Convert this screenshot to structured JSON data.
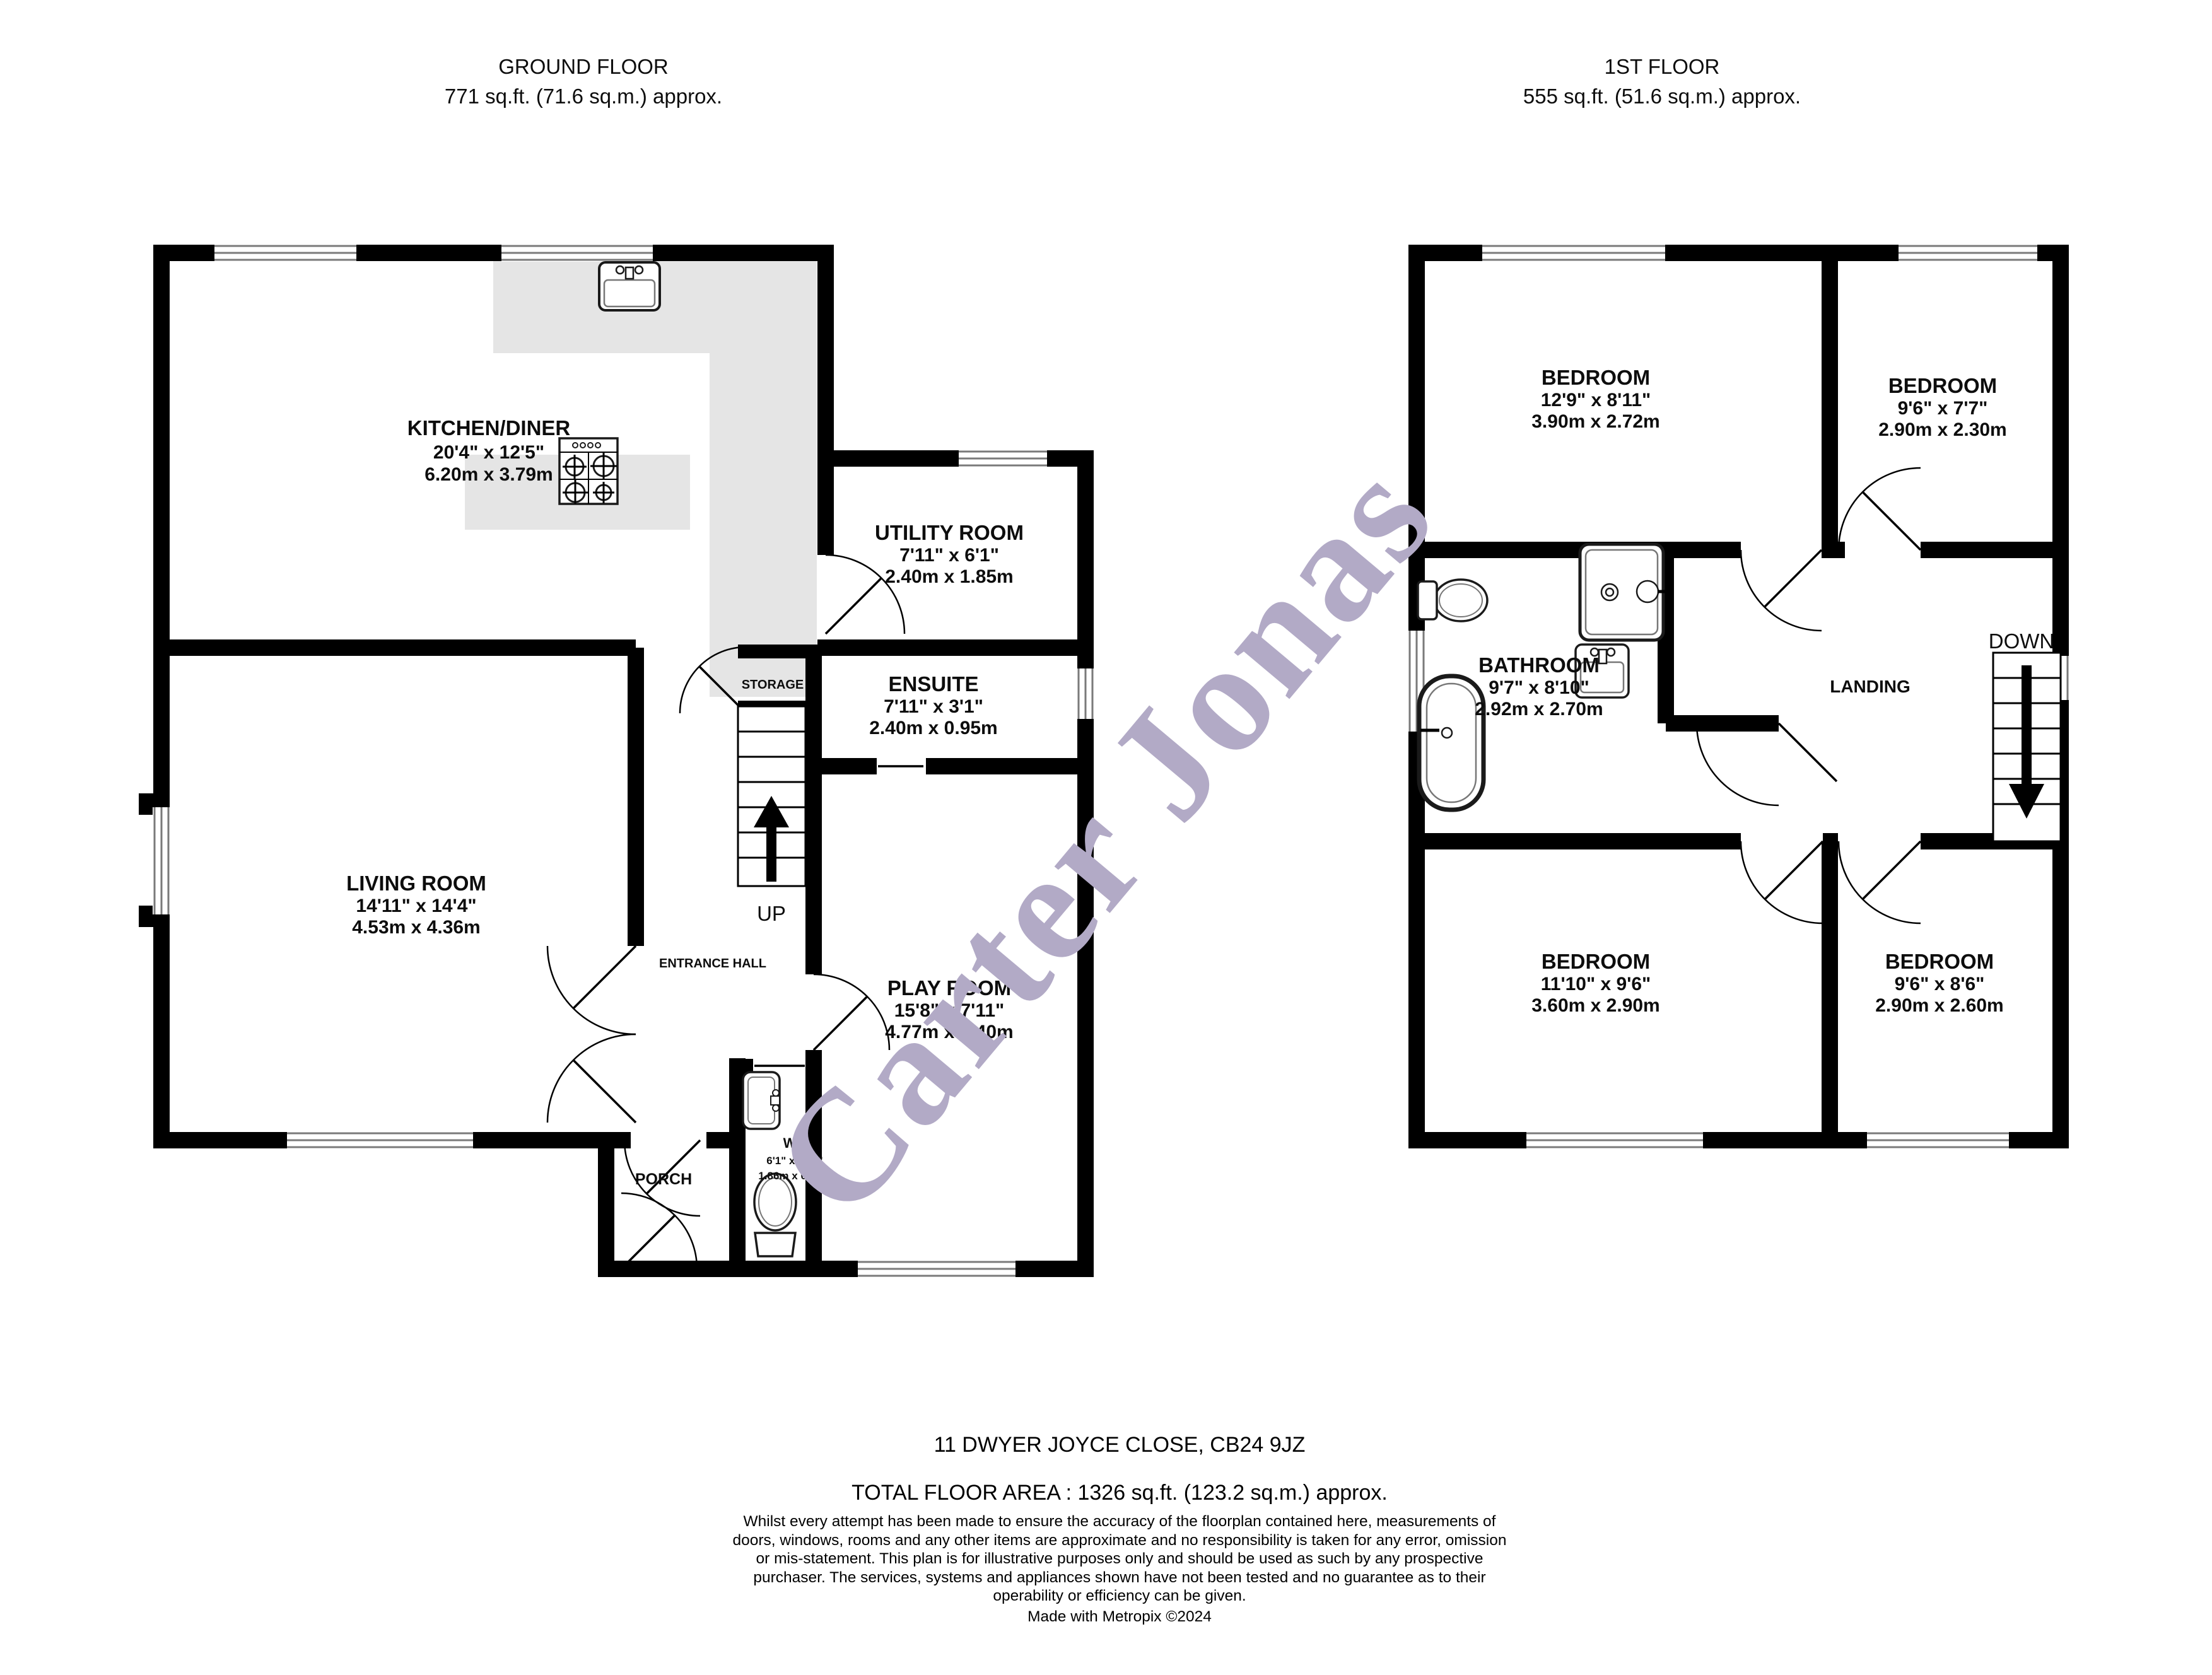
{
  "watermark": {
    "text": "Carter Jonas",
    "color": "#b2aac6"
  },
  "ground": {
    "title": "GROUND FLOOR",
    "area": "771 sq.ft. (71.6 sq.m.) approx.",
    "stairs": "UP",
    "rooms": {
      "kitchen": {
        "name": "KITCHEN/DINER",
        "imperial": "20'4\" x 12'5\"",
        "metric": "6.20m x 3.79m"
      },
      "utility": {
        "name": "UTILITY ROOM",
        "imperial": "7'11\" x 6'1\"",
        "metric": "2.40m x 1.85m"
      },
      "ensuite": {
        "name": "ENSUITE",
        "imperial": "7'11\" x 3'1\"",
        "metric": "2.40m x 0.95m"
      },
      "living": {
        "name": "LIVING ROOM",
        "imperial": "14'11\" x 14'4\"",
        "metric": "4.53m x 4.36m"
      },
      "playroom": {
        "name": "PLAY ROOM",
        "imperial": "15'8\" x 7'11\"",
        "metric": "4.77m x 2.40m"
      },
      "wc": {
        "name": "WC",
        "imperial": "6'1\" x 2'11\"",
        "metric": "1.86m x 0.88m"
      },
      "porch": {
        "name": "PORCH"
      },
      "storage": {
        "name": "STORAGE"
      },
      "hall": {
        "name": "ENTRANCE HALL"
      }
    }
  },
  "first": {
    "title": "1ST FLOOR",
    "area": "555 sq.ft. (51.6 sq.m.) approx.",
    "stairs": "DOWN",
    "rooms": {
      "bedroom1": {
        "name": "BEDROOM",
        "imperial": "12'9\" x 8'11\"",
        "metric": "3.90m x 2.72m"
      },
      "bedroom2": {
        "name": "BEDROOM",
        "imperial": "9'6\" x 7'7\"",
        "metric": "2.90m x 2.30m"
      },
      "bathroom": {
        "name": "BATHROOM",
        "imperial": "9'7\" x 8'10\"",
        "metric": "2.92m x 2.70m"
      },
      "bedroom3": {
        "name": "BEDROOM",
        "imperial": "11'10\" x 9'6\"",
        "metric": "3.60m x 2.90m"
      },
      "bedroom4": {
        "name": "BEDROOM",
        "imperial": "9'6\" x 8'6\"",
        "metric": "2.90m x 2.60m"
      },
      "landing": {
        "name": "LANDING"
      }
    }
  },
  "footer": {
    "address": "11 DWYER JOYCE CLOSE, CB24 9JZ",
    "total_area": "TOTAL FLOOR AREA : 1326 sq.ft. (123.2 sq.m.) approx.",
    "disclaimer": "Whilst every attempt has been made to ensure the accuracy of the floorplan contained here, measurements of doors, windows, rooms and any other items are approximate and no responsibility is taken for any error, omission or mis-statement. This plan is for illustrative purposes only and should be used as such by any prospective purchaser. The services, systems and appliances shown have not been tested and no guarantee as to their operability or efficiency can be given.",
    "credit": "Made with Metropix ©2024"
  },
  "colors": {
    "wall": "#000000",
    "counter": "#e5e5e5",
    "window_line": "#7a7a7a",
    "watermark": "#b2aac6"
  }
}
